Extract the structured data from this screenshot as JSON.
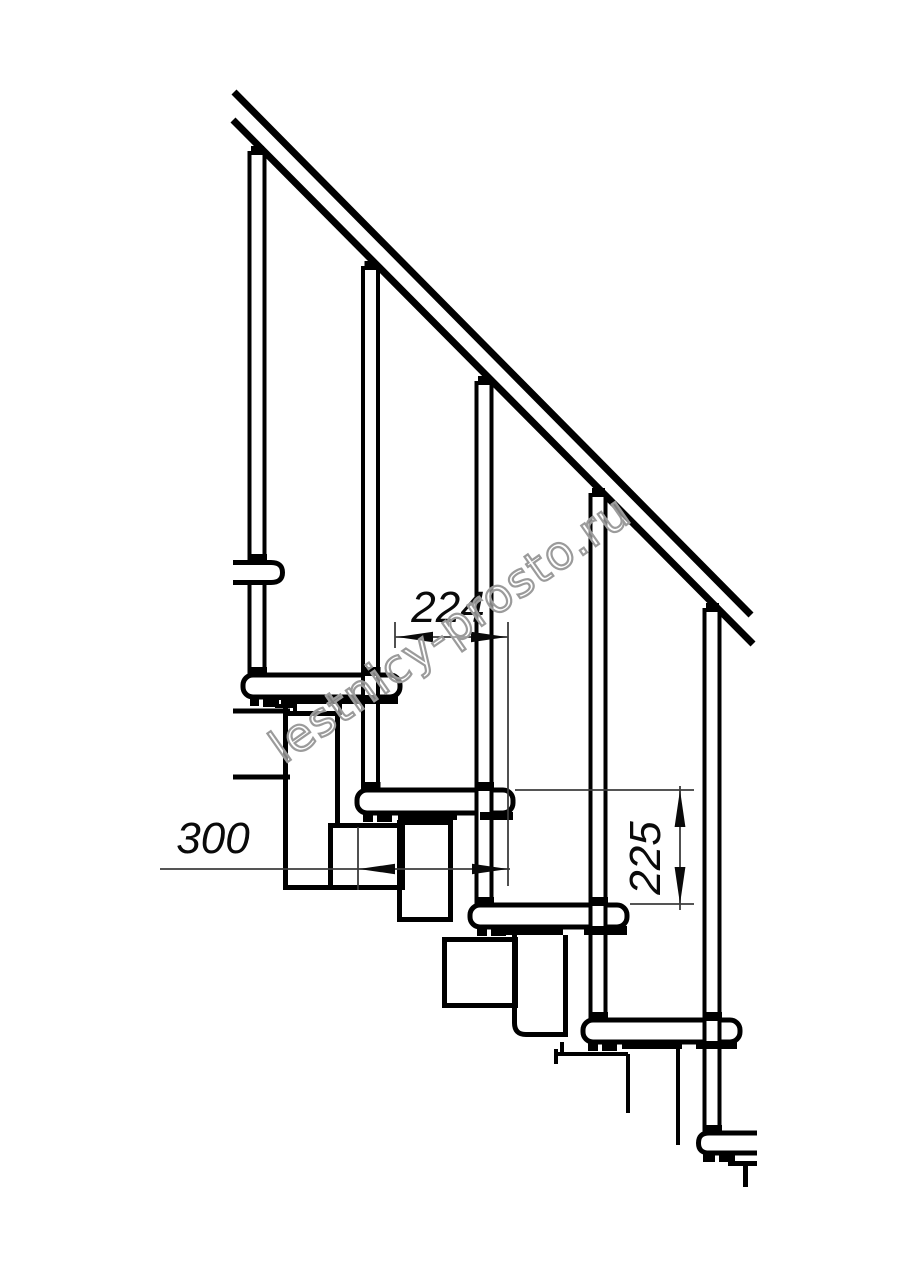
{
  "drawing": {
    "description": "Side-view technical drawing of a modular staircase flight: sloped handrail, five balusters, four treads on stacked riser modules, upper and lower cut-off mounting brackets",
    "dimension_labels": {
      "run": "224",
      "depth": "300",
      "rise": "225"
    },
    "watermark": {
      "text": "lestnicy-prosto.ru"
    },
    "colors": {
      "line": "#000000",
      "dimension_line": "#3d3d3d",
      "watermark_outline": "#9b9b9b",
      "background": "#ffffff"
    },
    "counts": {
      "treads": 4,
      "balusters": 5,
      "dimensions": 3
    }
  }
}
